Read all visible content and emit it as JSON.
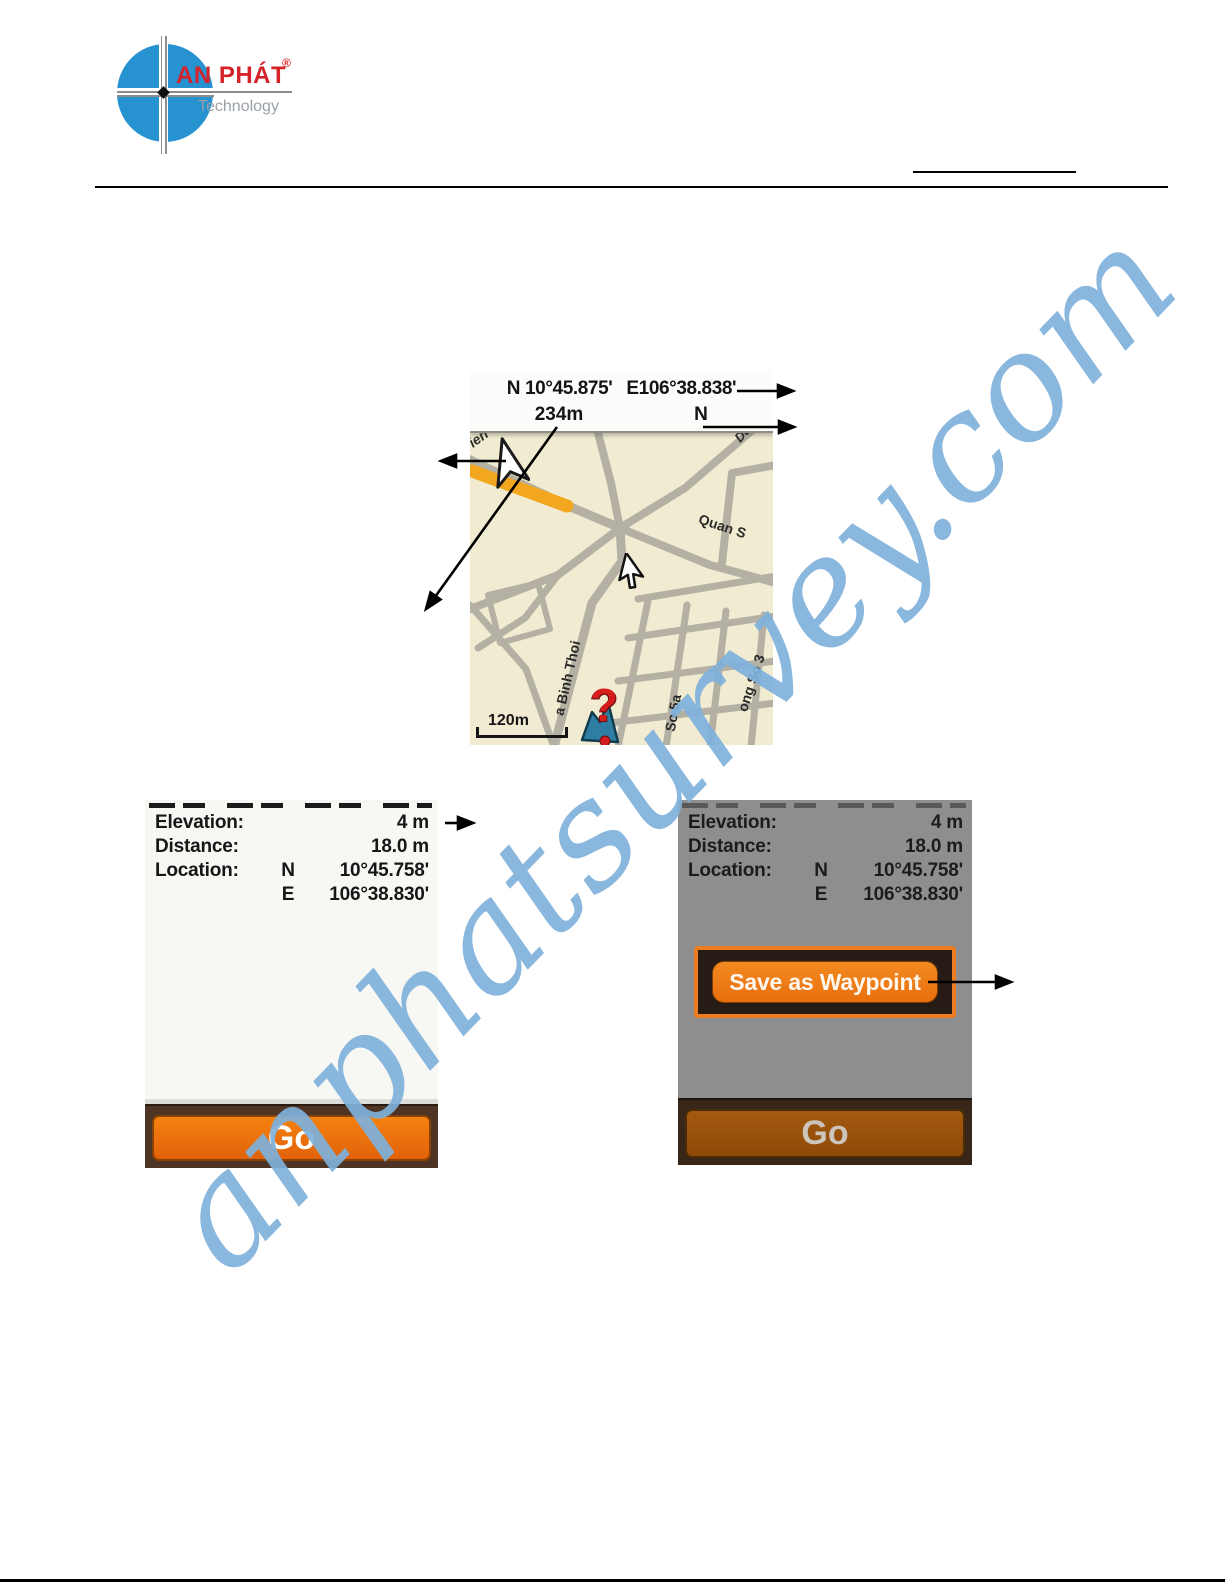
{
  "logo": {
    "brand": "AN PHÁT",
    "reg": "®",
    "tagline": "Technology"
  },
  "map": {
    "lat": "N 10°45.875'",
    "lon": "E106°38.838'",
    "elevation": "234m",
    "orientation": "N",
    "scale": "120m",
    "marker": "?",
    "streets": {
      "ien": "ien",
      "du": "Du",
      "quan_s": "Quan S",
      "binh_thoi": "a Binh Thoi",
      "so_5a": "So 5a",
      "ong_so_3": "ong So 3"
    }
  },
  "panel": {
    "rows": [
      {
        "label": "Elevation:",
        "dir": "",
        "value": "4 m"
      },
      {
        "label": "Distance:",
        "dir": "",
        "value": "18.0 m"
      },
      {
        "label": "Location:",
        "dir": "N",
        "value": "10°45.758'"
      },
      {
        "label": "",
        "dir": "E",
        "value": "106°38.830'"
      }
    ],
    "go": "Go",
    "save": "Save as Waypoint"
  },
  "watermark": "anphatsurvey.com",
  "colors": {
    "accent_orange": "#ee7212",
    "map_route_orange": "#f3a71f",
    "watermark_blue": "#7fb1dc",
    "panel_dim_gray": "#8e8e8e",
    "logo_blue": "#2692d0",
    "logo_red": "#d6232b"
  }
}
